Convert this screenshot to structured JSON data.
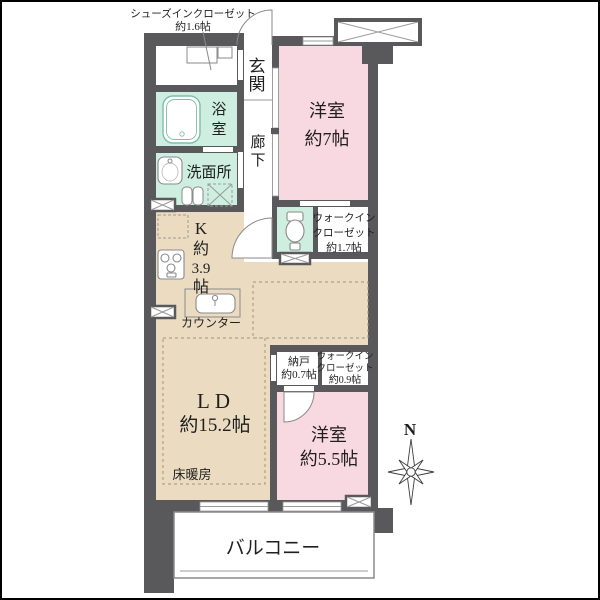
{
  "figure_type": "apartment-floor-plan",
  "colors": {
    "wall": "#59595c",
    "bedroom_pink": "#f9d9e1",
    "ldk_beige": "#ebdcc1",
    "wet_area_mint": "#cdeee1",
    "fixture_line": "#8a8a8a",
    "text": "#1f1f1f",
    "frame": "#000000"
  },
  "rooms": {
    "shoe_closet": {
      "label_lines": [
        "シューズインクローゼット",
        "約1.6帖"
      ]
    },
    "entrance": {
      "chars": [
        "玄",
        "関"
      ]
    },
    "bath": {
      "chars": [
        "浴",
        "室"
      ]
    },
    "corridor": {
      "chars": [
        "廊",
        "下"
      ]
    },
    "washroom": {
      "label": "洗面所"
    },
    "kitchen": {
      "label_lines": [
        "K",
        "約",
        "3.9",
        "帖"
      ],
      "counter": "カウンター"
    },
    "bedroom_7": {
      "label_lines": [
        "洋室",
        "約7帖"
      ]
    },
    "wic_17": {
      "label_lines": [
        "ウォークイン",
        "クローゼット",
        "約1.7帖"
      ]
    },
    "living_dining": {
      "label_lines": [
        "LD",
        "約15.2帖"
      ],
      "floor_heating": "床暖房"
    },
    "storage": {
      "label_lines": [
        "納戸",
        "約0.7帖"
      ]
    },
    "wic_09": {
      "label_lines": [
        "ウォークイン",
        "クローゼット",
        "約0.9帖"
      ]
    },
    "bedroom_55": {
      "label_lines": [
        "洋室",
        "約5.5帖"
      ]
    },
    "balcony": {
      "label": "バルコニー"
    }
  },
  "compass": {
    "label": "N"
  }
}
